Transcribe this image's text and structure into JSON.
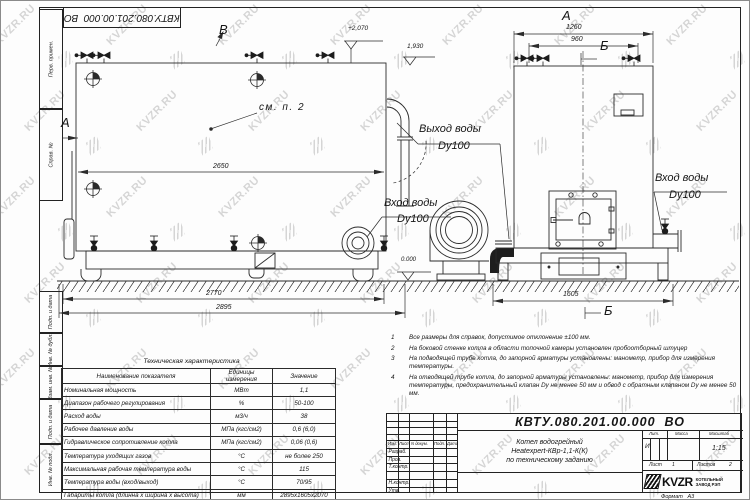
{
  "watermark": {
    "text": "KVZR.RU"
  },
  "frame": {
    "top_stamp": "КВТУ.080.201.00.000  ВО",
    "left_labels": [
      "Перв. примен.",
      "Справ. №",
      "Подп. и дата",
      "Инв. № дубл.",
      "Взам. инв. №",
      "Подп. и дата",
      "Инв. № подл."
    ]
  },
  "side_view": {
    "view_b": "В",
    "view_a": "А",
    "elev_top": "+2,070",
    "elev_step": "1,930",
    "elev_zero": "0.000",
    "see_note": "см. п. 2",
    "dim_2650": "2650",
    "dim_2770": "2770",
    "dim_2895": "2895",
    "inlet_line1": "Вход воды",
    "inlet_line2": "Dy100"
  },
  "front_view": {
    "view_a": "А",
    "dim_1260": "1260",
    "dim_960": "960",
    "section_b_top": "Б",
    "section_b_bottom": "Б",
    "dim_1605": "1605",
    "outlet_line1": "Выход воды",
    "outlet_line2": "Dy100",
    "inlet_line1": "Вход воды",
    "inlet_line2": "Dy100"
  },
  "notes": [
    {
      "num": "1",
      "text": "Все размеры для справок, допустимое отклонение  ±100 мм."
    },
    {
      "num": "2",
      "text": "На боковой стенке котла в области топочной камеры установлен пробоотборный штуцер"
    },
    {
      "num": "3",
      "text": "На  подводящей трубе котла, до запорной арматуры установлены: манометр, прибор для измерения температуры."
    },
    {
      "num": "4",
      "text": "На отводящей трубе котла, до запорной арматуры установлены: манометр, прибор для измерения температуры, предохранительный клапан Dу не менее 50 мм и обвод с обратным клапаном Dу не менее 50 мм."
    }
  ],
  "tech_table": {
    "title": "Техническая характеристика",
    "col_name": "Наименование показателя",
    "col_units": "Единицы измерения",
    "col_value": "Значение",
    "rows": [
      {
        "name": "Номинальная мощность",
        "unit": "МВт",
        "value": "1,1"
      },
      {
        "name": "Диапазон рабочего регулирования",
        "unit": "%",
        "value": "50-100"
      },
      {
        "name": "Расход воды",
        "unit": "м3/ч",
        "value": "38"
      },
      {
        "name": "Рабочее давление воды",
        "unit": "МПа (кгс/см2)",
        "value": "0,6 (6,0)"
      },
      {
        "name": "Гидравлическое сопротивление котла",
        "unit": "МПа (кгс/см2)",
        "value": "0,06 (0,6)"
      },
      {
        "name": "Температура уходящих газов",
        "unit": "°С",
        "value": "не более 250"
      },
      {
        "name": "Максимальная рабочая температура воды",
        "unit": "°С",
        "value": "115"
      },
      {
        "name": "Температура воды (вход/выход)",
        "unit": "°С",
        "value": "70/95"
      },
      {
        "name": "Габариты котла (длинна х ширина х высота)",
        "unit": "мм",
        "value": "2895х1605х2070"
      }
    ]
  },
  "title_block": {
    "designation": "КВТУ.080.201.00.000  ВО",
    "header_cols": [
      "Изм.",
      "Лист",
      "N докум.",
      "Подп.",
      "Дата"
    ],
    "rows": [
      "Разраб.",
      "Пров.",
      "Т.контр.",
      "",
      "Н.контр.",
      "Утв."
    ],
    "doc_name_line1": "Котел водогрейный",
    "doc_name_line2": "Heatexpert-КВр-1,1-К(К)",
    "doc_name_line3": "по техническому заданию",
    "lit_label": "Лит.",
    "lit_value": "И",
    "mass_label": "Масса",
    "mass_value": "",
    "scale_label": "Масштаб",
    "scale_value": "1:15",
    "sheet_label": "Лист",
    "sheet_value": "1",
    "sheets_label": "Листов",
    "sheets_value": "2",
    "logo": "KVZR",
    "company_line1": "КОТЕЛЬНЫЙ",
    "company_line2": "ЗАВОД РЭП",
    "format_label": "Формат",
    "format_value": "А3"
  }
}
